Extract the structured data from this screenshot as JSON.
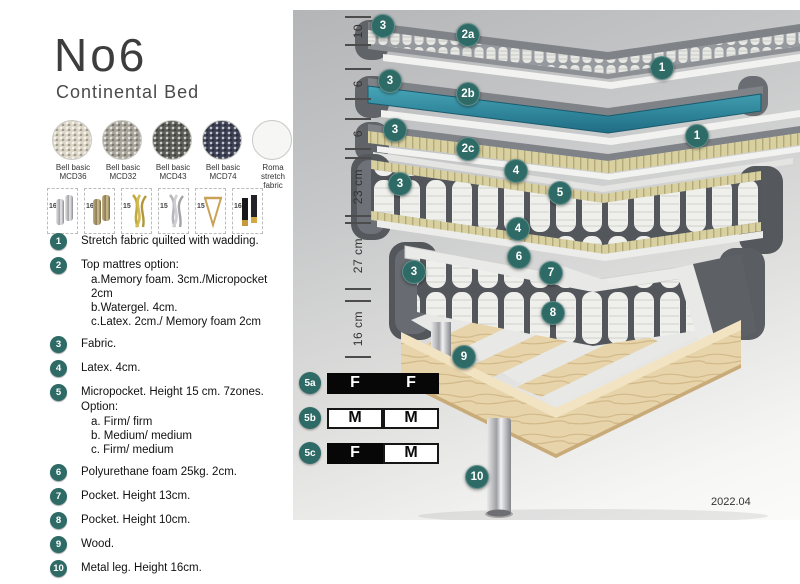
{
  "title": "No6",
  "subtitle": "Continental Bed",
  "colors": {
    "accent_teal_badge": "#2e6b66",
    "watergel_teal": "#2c8aa0",
    "mattress_gray": "#5d6166",
    "foam_yellow": "#d8d0a0",
    "wood": "#e7d4aa",
    "panel_bg_top": "#b4b5b7",
    "panel_bg_bottom": "#fbfbfa"
  },
  "swatches": [
    {
      "line1": "Bell basic",
      "line2": "MCD36",
      "color": "#ddd6c6"
    },
    {
      "line1": "Bell basic",
      "line2": "MCD32",
      "color": "#a9a59b"
    },
    {
      "line1": "Bell basic",
      "line2": "MCD43",
      "color": "#5c5c58"
    },
    {
      "line1": "Bell basic",
      "line2": "MCD74",
      "color": "#3d4156"
    },
    {
      "line1": "Roma",
      "line2": "stretch fabric",
      "color": "#f6f6f4"
    }
  ],
  "legs_options": [
    {
      "height": "16",
      "type": "cylinder-silver-leg"
    },
    {
      "height": "16",
      "type": "cylinder-brass-leg"
    },
    {
      "height": "15",
      "type": "twist-gold-leg"
    },
    {
      "height": "15",
      "type": "twist-silver-leg"
    },
    {
      "height": "15",
      "type": "hairpin-leg"
    },
    {
      "height": "16",
      "type": "block-black-gold-leg"
    }
  ],
  "legend": {
    "items": [
      {
        "num": "1",
        "text": "Stretch fabric quilted with wadding.",
        "sub": []
      },
      {
        "num": "2",
        "text": "Top mattres option:",
        "sub": [
          "a.Memory foam. 3cm./Micropocket 2cm",
          "b.Watergel. 4cm.",
          "c.Latex. 2cm./ Memory foam 2cm"
        ]
      },
      {
        "num": "3",
        "text": "Fabric.",
        "sub": []
      },
      {
        "num": "4",
        "text": "Latex. 4cm.",
        "sub": []
      },
      {
        "num": "5",
        "text": "Micropocket. Height 15 cm. 7zones. Option:",
        "sub": [
          "a. Firm/ firm",
          "b. Medium/ medium",
          "c. Firm/ medium"
        ]
      },
      {
        "num": "6",
        "text": "Polyurethane foam 25kg. 2cm.",
        "sub": []
      },
      {
        "num": "7",
        "text": "Pocket. Height 13cm.",
        "sub": []
      },
      {
        "num": "8",
        "text": "Pocket. Height 10cm.",
        "sub": []
      },
      {
        "num": "9",
        "text": "Wood.",
        "sub": []
      },
      {
        "num": "10",
        "text": "Metal leg. Height 16cm.",
        "sub": []
      }
    ]
  },
  "diagram": {
    "dimensions": [
      {
        "label": "10"
      },
      {
        "label": "6"
      },
      {
        "label": "6"
      },
      {
        "label": "23 cm"
      },
      {
        "label": "27 cm"
      },
      {
        "label": "16 cm"
      }
    ],
    "callouts": [
      {
        "label": "3"
      },
      {
        "label": "2a"
      },
      {
        "label": "1"
      },
      {
        "label": "3"
      },
      {
        "label": "2b"
      },
      {
        "label": "1"
      },
      {
        "label": "3"
      },
      {
        "label": "2c"
      },
      {
        "label": "3"
      },
      {
        "label": "4"
      },
      {
        "label": "5"
      },
      {
        "label": "4"
      },
      {
        "label": "3"
      },
      {
        "label": "6"
      },
      {
        "label": "7"
      },
      {
        "label": "8"
      },
      {
        "label": "9"
      },
      {
        "label": "10"
      }
    ],
    "firmness_table": {
      "rows": [
        {
          "label": "5a",
          "cells": [
            {
              "text": "F",
              "filled": true
            },
            {
              "text": "F",
              "filled": true
            }
          ]
        },
        {
          "label": "5b",
          "cells": [
            {
              "text": "M",
              "filled": false
            },
            {
              "text": "M",
              "filled": false
            }
          ]
        },
        {
          "label": "5c",
          "cells": [
            {
              "text": "F",
              "filled": true
            },
            {
              "text": "M",
              "filled": false
            }
          ]
        }
      ]
    },
    "version": "2022.04"
  }
}
